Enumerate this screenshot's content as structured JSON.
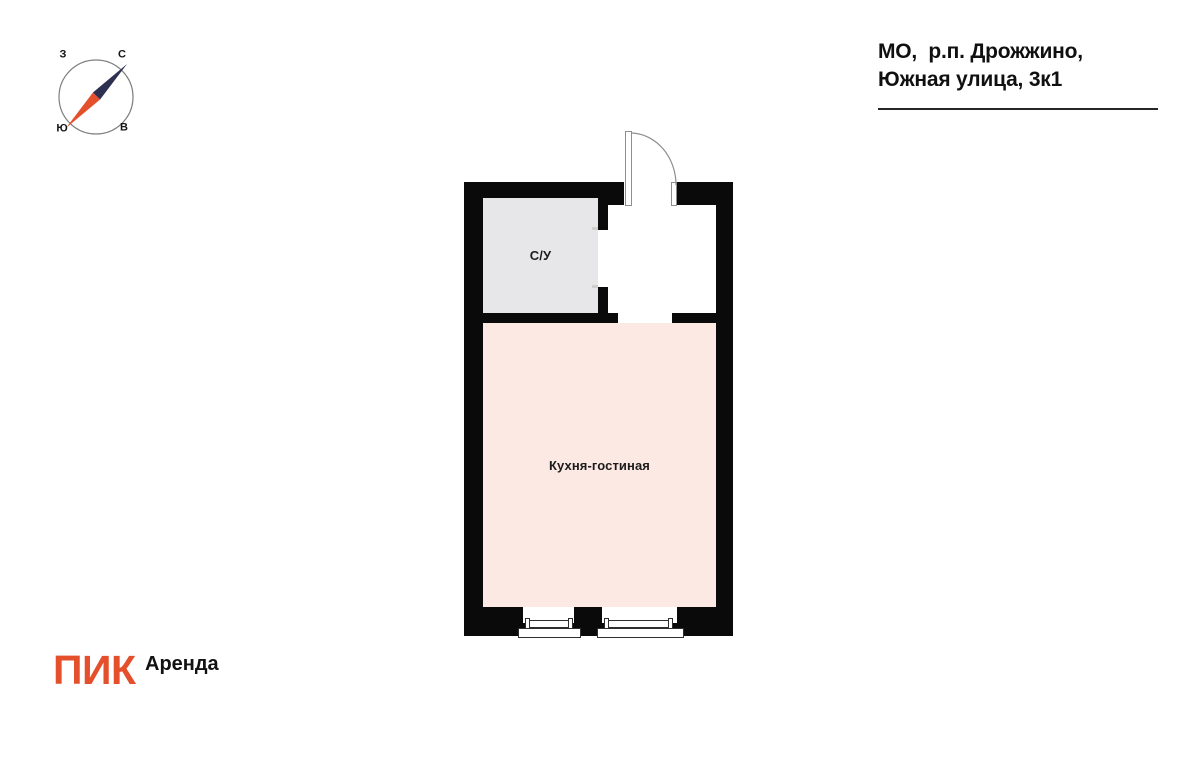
{
  "address": {
    "line1": "МО,  р.п. Дрожжино,",
    "line2": "Южная улица, 3к1"
  },
  "compass": {
    "labels": {
      "west": "З",
      "north": "С",
      "south": "Ю",
      "east": "В"
    },
    "ring_color": "#7F7F7F",
    "needle_north_color": "#2E3052",
    "needle_south_color": "#E4502C"
  },
  "floor_plan": {
    "wall_color": "#0A0A0A",
    "rooms": [
      {
        "name": "bathroom",
        "label": "С/У",
        "fill": "#E7E7E9"
      },
      {
        "name": "kitchen-living",
        "label": "Кухня-гостиная",
        "fill": "#FDE9E4"
      }
    ],
    "features": [
      "entrance-door",
      "bathroom-door-opening",
      "window",
      "window"
    ]
  },
  "branding": {
    "logo": "ПИК",
    "logo_color": "#E4502C",
    "suffix": "Аренда"
  }
}
